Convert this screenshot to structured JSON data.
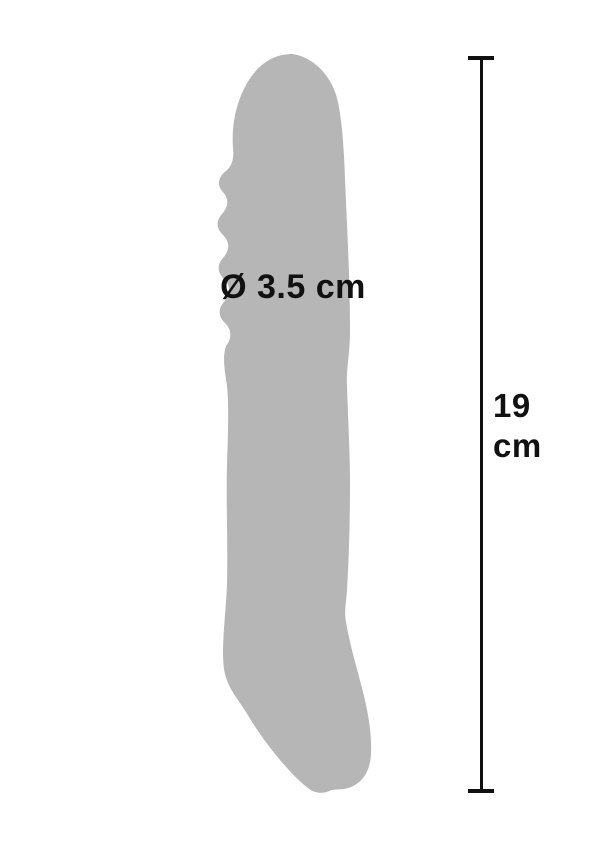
{
  "diagram": {
    "diameter_label": "Ø 3.5 cm",
    "length_value": "19",
    "length_unit": "cm",
    "measurements": {
      "diameter_cm": 3.5,
      "length_cm": 19
    }
  },
  "colors": {
    "background": "#ffffff",
    "product_silhouette": "#b5b6b5",
    "text": "#111111",
    "measure_line": "#111111"
  }
}
